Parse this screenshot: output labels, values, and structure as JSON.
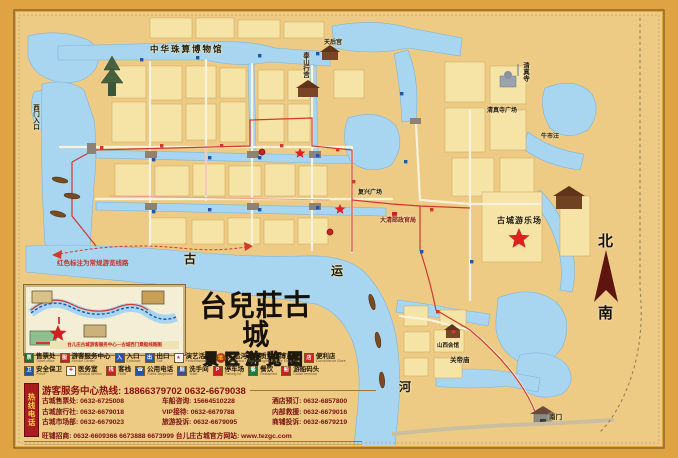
{
  "title": {
    "main": "台兒莊古城",
    "subtitle": "景区游览图"
  },
  "compass": {
    "north": "北",
    "south": "南"
  },
  "map": {
    "route_note": "红色标注为常规游览线路",
    "labels": {
      "abacus_museum": "中华珠算博物馆",
      "mosque": "清真寺",
      "mosque_square": "清真寺广场",
      "niushiwang": "牛市汪",
      "amusement_park": "古城游乐场",
      "taishan_palace": "泰山行宫",
      "tianhou_temple": "天后宫",
      "fuxing_square": "复兴广场",
      "qing_post_office": "大清邮政官局",
      "guandi_temple": "关帝庙",
      "shanxi_guild": "山西会馆",
      "south_gate": "南门",
      "west_gate_entrance": "西门入口",
      "canal_char_1": "古",
      "canal_char_2": "运",
      "canal_char_3": "河"
    }
  },
  "inset": {
    "caption": "台儿庄古城游客服务中心—古城西门乘船线路图"
  },
  "legend": {
    "items": [
      {
        "label": "售票处",
        "en": "Ticket office",
        "glyph": "票",
        "bg": "#1e6b34",
        "fg": "#ffffff"
      },
      {
        "label": "游客服务中心",
        "en": "Service Center",
        "glyph": "服",
        "bg": "#c42323",
        "fg": "#ffffff"
      },
      {
        "label": "入口",
        "en": "Entrance",
        "glyph": "入",
        "bg": "#2456a8",
        "fg": "#ffffff"
      },
      {
        "label": "出口",
        "en": "Exit",
        "glyph": "出",
        "bg": "#2456a8",
        "fg": "#ffffff"
      },
      {
        "label": "演艺活动",
        "en": "Performances",
        "glyph": "★",
        "bg": "#ffffff",
        "fg": "#d42020"
      },
      {
        "label": "大运河非物质文化博览园",
        "en": "The Grand Canal Intangible Culture Expo Park",
        "glyph": "运",
        "bg": "#c42323",
        "fg": "#ffd700"
      },
      {
        "label": "便利店",
        "en": "Convenience Store",
        "glyph": "店",
        "bg": "#d42020",
        "fg": "#ffffff"
      },
      {
        "label": "安全保卫",
        "en": "Police",
        "glyph": "卫",
        "bg": "#2456a8",
        "fg": "#ffffff"
      },
      {
        "label": "医务室",
        "en": "Medical service",
        "glyph": "✚",
        "bg": "#ffffff",
        "fg": "#d42020"
      },
      {
        "label": "客栈",
        "en": "Hotel",
        "glyph": "栈",
        "bg": "#c42323",
        "fg": "#ffffff"
      },
      {
        "label": "公用电话",
        "en": "Public telephone",
        "glyph": "☎",
        "bg": "#2456a8",
        "fg": "#ffffff"
      },
      {
        "label": "洗手间",
        "en": "Toilet",
        "glyph": "厕",
        "bg": "#34558b",
        "fg": "#ffffff"
      },
      {
        "label": "停车场",
        "en": "Parking lot",
        "glyph": "P",
        "bg": "#d42020",
        "fg": "#ffffff"
      },
      {
        "label": "餐饮",
        "en": "Restaurant",
        "glyph": "餐",
        "bg": "#1e7a3c",
        "fg": "#ffffff"
      },
      {
        "label": "游船码头",
        "en": "Cruise terminal",
        "glyph": "船",
        "bg": "#c42323",
        "fg": "#ffffff"
      }
    ]
  },
  "hotline": {
    "tab": "热线电话",
    "main": "游客服务中心热线: 18866379702 0632-6679038",
    "rows": [
      [
        "古城售票处: 0632-6725008",
        "车船咨询: 15664510228",
        "酒店预订: 0632-6857800"
      ],
      [
        "古城旅行社: 0632-6679018",
        "VIP接待: 0632-6679788",
        "内部救援: 0632-6679016"
      ],
      [
        "古城市场部: 0632-6679023",
        "旅游投诉: 0632-6679095",
        "商铺投诉: 0632-6679219"
      ]
    ],
    "last": "旺铺招商: 0632-6609366 6673888 6673999  台儿庄古城官方网站: www.tezgc.com"
  },
  "colors": {
    "frame": "#e0a343",
    "paper": "#edcb85",
    "water": "#a8d5ef",
    "block": "#f6e3a6",
    "route_red": "#d2382b",
    "maroon": "#7a1010"
  }
}
